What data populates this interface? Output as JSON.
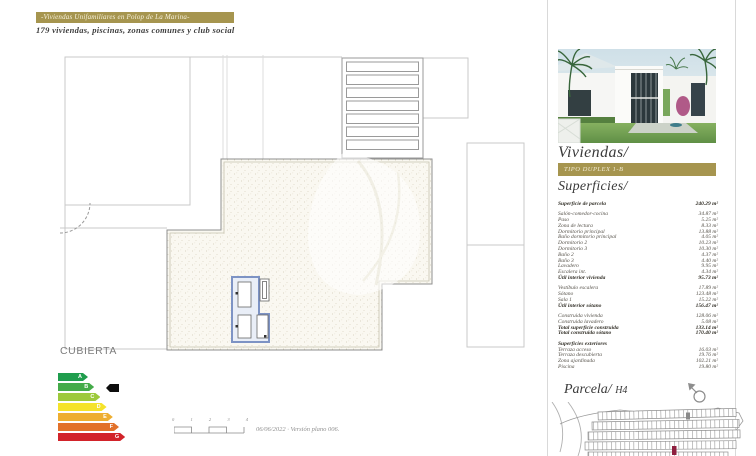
{
  "header": {
    "banner_text": "-Viviendas Unifamiliares en Polop de La Marina-",
    "subtitle": "179 viviendas, piscinas, zonas comunes y club social"
  },
  "plan": {
    "label": "CUBIERTA"
  },
  "energy_label": {
    "grades": [
      {
        "letter": "A",
        "color": "#1f9d4d"
      },
      {
        "letter": "B",
        "color": "#44ab49"
      },
      {
        "letter": "C",
        "color": "#9dc93b"
      },
      {
        "letter": "D",
        "color": "#f5e32a"
      },
      {
        "letter": "E",
        "color": "#eeae30"
      },
      {
        "letter": "F",
        "color": "#e2712a"
      },
      {
        "letter": "G",
        "color": "#d2232a"
      }
    ],
    "pointer_grade": "B"
  },
  "scale_bar": {
    "ticks": [
      "0",
      "1",
      "2",
      "3",
      "4"
    ],
    "note": "06/06/2022 · Versión plano 006."
  },
  "sidebar": {
    "homes_title": "Viviendas/",
    "type_banner": "TIPO DUPLEX 1-B",
    "surfaces_title": "Superficies/",
    "sections": [
      {
        "rows": [
          {
            "label": "Superficie de parcela",
            "value": "240.29 m²",
            "bold": true
          }
        ]
      },
      {
        "rows": [
          {
            "label": "Salón-comedor-cocina",
            "value": "34.87 m²"
          },
          {
            "label": "Paso",
            "value": "5.25 m²"
          },
          {
            "label": "Zona de lectura",
            "value": "8.33 m²"
          },
          {
            "label": "Dormitorio principal",
            "value": "13.88 m²"
          },
          {
            "label": "Baño dormitorio principal",
            "value": "4.05 m²"
          },
          {
            "label": "Dormitorio 2",
            "value": "10.23 m²"
          },
          {
            "label": "Dormitorio 3",
            "value": "10.30 m²"
          },
          {
            "label": "Baño 2",
            "value": "4.37 m²"
          },
          {
            "label": "Baño 3",
            "value": "4.40 m²"
          },
          {
            "label": "Lavadero",
            "value": "9.95 m²"
          },
          {
            "label": "Escalera int.",
            "value": "4.34 m²"
          },
          {
            "label": "Útil interior vivienda",
            "value": "95.73 m²",
            "bold": true
          }
        ]
      },
      {
        "rows": [
          {
            "label": "Vestíbulo escalera",
            "value": "17.89 m²"
          },
          {
            "label": "Sótano",
            "value": "123.48 m²"
          },
          {
            "label": "Sala 1",
            "value": "15.22 m²"
          },
          {
            "label": "Útil interior sótano",
            "value": "156.47 m²",
            "bold": true
          }
        ]
      },
      {
        "rows": [
          {
            "label": "Construida vivienda",
            "value": "128.06 m²"
          },
          {
            "label": "Construida lavadero",
            "value": "5.08 m²"
          },
          {
            "label": "Total superficie construida",
            "value": "133.14 m²",
            "bold": true
          },
          {
            "label": "Total construida sótano",
            "value": "170.40 m²",
            "bold": true
          }
        ]
      },
      {
        "rows": [
          {
            "label": "Superficies exteriores",
            "header": true
          },
          {
            "label": "Terraza acceso",
            "value": "16.03 m²"
          },
          {
            "label": "Terraza descubierta",
            "value": "19.76 m²"
          },
          {
            "label": "Zona ajardinada",
            "value": "102.21 m²"
          },
          {
            "label": "Piscina",
            "value": "19.80 m²"
          }
        ]
      }
    ],
    "parcel_title": "Parcela/",
    "parcel_code": "H4"
  },
  "colors": {
    "gold": "#a6954f",
    "highlight_maroon": "#8E1F3F",
    "roof_fill": "#faf8f1",
    "skylight_blue": "#7d93c4"
  }
}
